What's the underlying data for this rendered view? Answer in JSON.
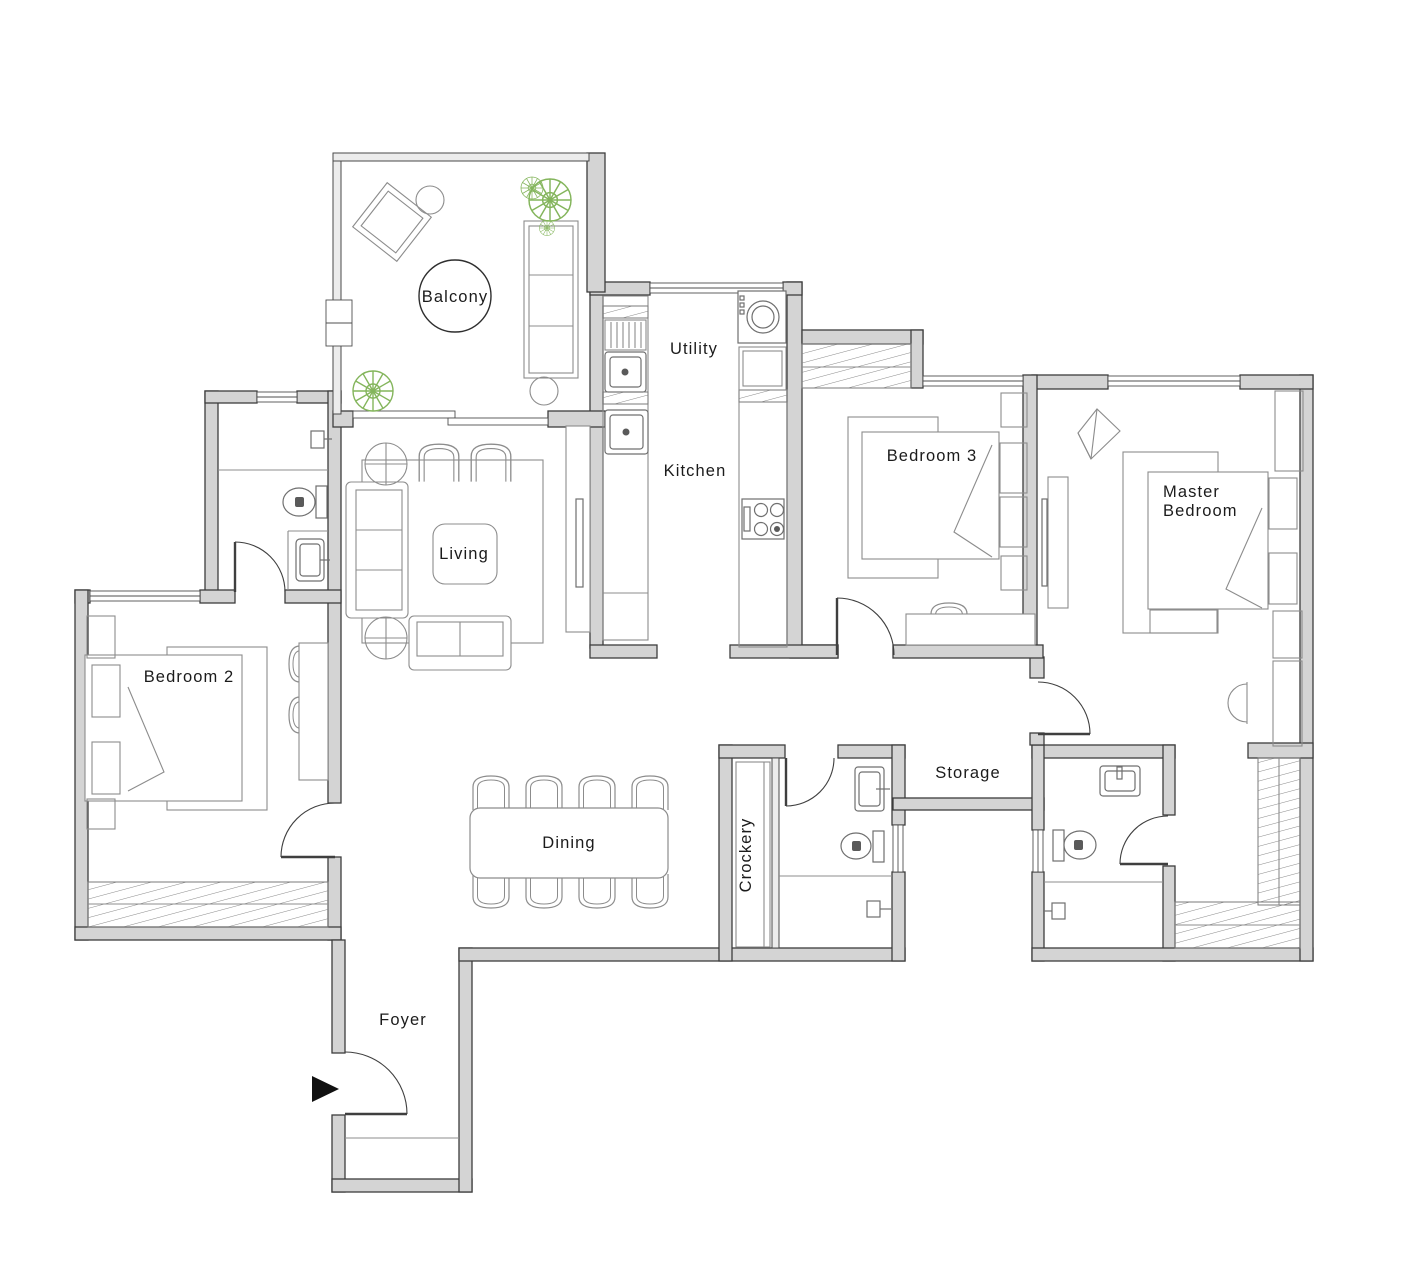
{
  "plan": {
    "rooms": {
      "balcony": {
        "label": "Balcony"
      },
      "utility": {
        "label": "Utility"
      },
      "kitchen": {
        "label": "Kitchen"
      },
      "bedroom3": {
        "label": "Bedroom 3"
      },
      "master_bedroom": {
        "label_line1": "Master",
        "label_line2": "Bedroom"
      },
      "living": {
        "label": "Living"
      },
      "bedroom2": {
        "label": "Bedroom 2"
      },
      "dining": {
        "label": "Dining"
      },
      "crockery": {
        "label": "Crockery"
      },
      "storage": {
        "label": "Storage"
      },
      "foyer": {
        "label": "Foyer"
      }
    },
    "colors": {
      "background": "#ffffff",
      "wall_fill": "#d4d4d4",
      "wall_stroke": "#3d3d3d",
      "furniture_stroke": "#8c8c8c",
      "window_stroke": "#4f4f4f",
      "label_color": "#1b1b1b",
      "plant_green": "#84b55c",
      "entry_arrow": "#111111"
    }
  }
}
